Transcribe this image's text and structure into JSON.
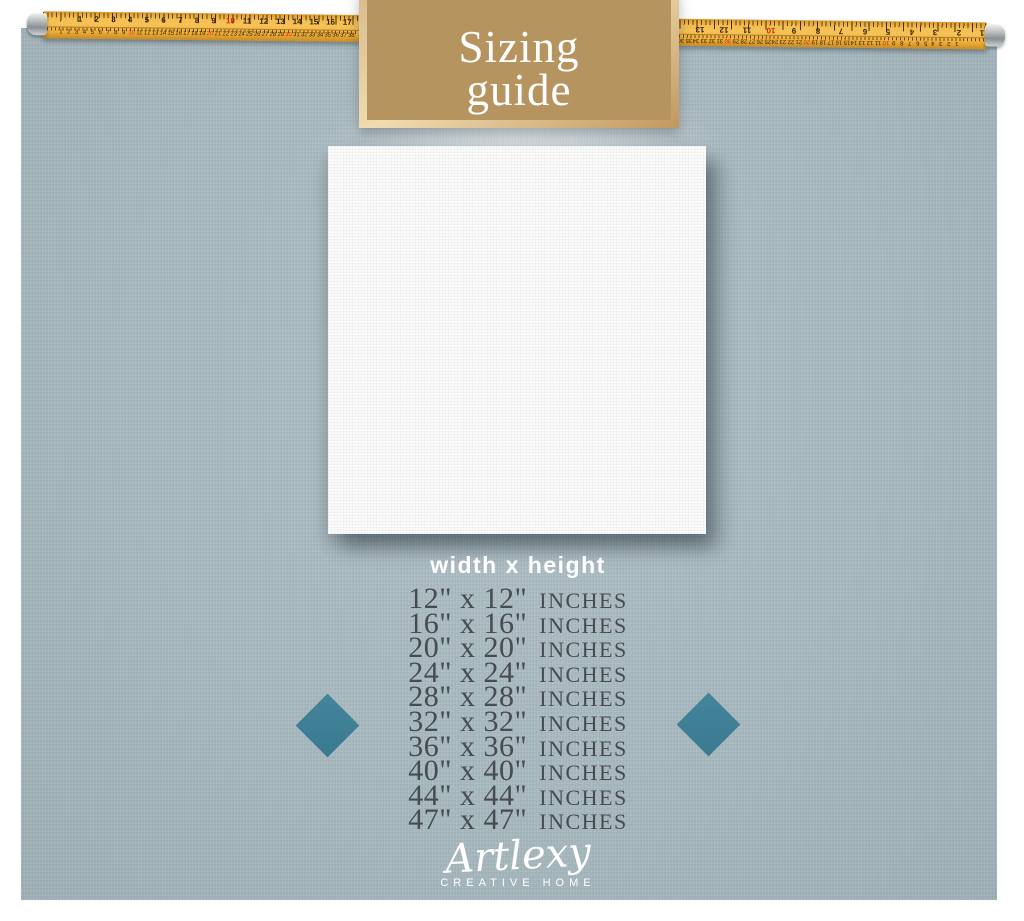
{
  "banner": {
    "title_line1": "Sizing",
    "title_line2": "guide"
  },
  "ruler": {
    "left_inch_numbers": [
      "1",
      "2",
      "3",
      "4",
      "5",
      "6",
      "7",
      "8",
      "9",
      "10",
      "11",
      "12",
      "13",
      "14",
      "15",
      "16",
      "17"
    ],
    "right_inch_numbers": [
      "13",
      "12",
      "11",
      "10",
      "9",
      "8",
      "7",
      "6",
      "5",
      "4",
      "3",
      "2",
      "1"
    ],
    "left_cm_numbers": [
      "1",
      "2",
      "3",
      "4",
      "5",
      "6",
      "7",
      "8",
      "9",
      "10",
      "11",
      "12",
      "13",
      "14",
      "15",
      "16",
      "17",
      "18",
      "19",
      "20",
      "21",
      "22",
      "23",
      "24",
      "25",
      "26",
      "27",
      "28",
      "29",
      "30",
      "31",
      "32",
      "33",
      "34",
      "35",
      "36",
      "37",
      "38"
    ],
    "right_cm_numbers": [
      "40",
      "39",
      "38",
      "37",
      "36",
      "35",
      "34",
      "33",
      "32",
      "31",
      "30",
      "29",
      "28",
      "27",
      "26",
      "25",
      "24",
      "23",
      "22",
      "21",
      "20",
      "19",
      "18",
      "17",
      "16",
      "15",
      "14",
      "13",
      "12",
      "11",
      "10",
      "9",
      "8",
      "7",
      "6",
      "5",
      "4",
      "3",
      "2",
      "1"
    ]
  },
  "size_guide": {
    "heading": "width x height",
    "rows": [
      {
        "dimensions": "12\" x 12\"",
        "unit": "INCHES"
      },
      {
        "dimensions": "16\" x 16\"",
        "unit": "INCHES"
      },
      {
        "dimensions": "20\" x 20\"",
        "unit": "INCHES"
      },
      {
        "dimensions": "24\" x 24\"",
        "unit": "INCHES"
      },
      {
        "dimensions": "28\" x 28\"",
        "unit": "INCHES"
      },
      {
        "dimensions": "32\" x 32\"",
        "unit": "INCHES"
      },
      {
        "dimensions": "36\" x 36\"",
        "unit": "INCHES"
      },
      {
        "dimensions": "40\" x 40\"",
        "unit": "INCHES"
      },
      {
        "dimensions": "44\" x 44\"",
        "unit": "INCHES"
      },
      {
        "dimensions": "47\" x 47\"",
        "unit": "INCHES"
      }
    ]
  },
  "brand": {
    "name": "Artlexy",
    "tagline": "CREATIVE HOME"
  },
  "colors": {
    "panel_background": "#a6b7be",
    "banner_fill": "#b5945f",
    "banner_border": "#e9d2a6",
    "tape_yellow": "#f2b647",
    "tape_red_number": "#d42b00",
    "diamond_accent": "#3d7e96",
    "size_text": "#474c52",
    "light_text": "#ffffff"
  }
}
